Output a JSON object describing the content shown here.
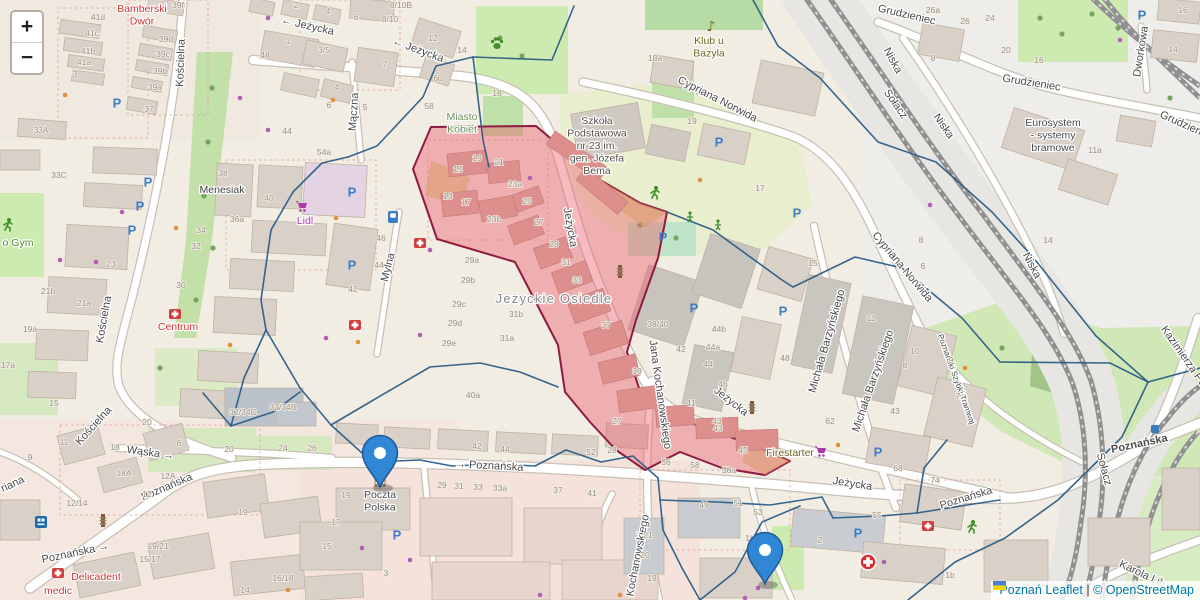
{
  "controls": {
    "zoom_in": "+",
    "zoom_out": "−"
  },
  "attribution": {
    "city": "Poznań",
    "leaflet": "Leaflet",
    "sep": " | ",
    "osm": "© OpenStreetMap"
  },
  "colors": {
    "overlay_blue": "#2c5d86",
    "highlight_fill": "#ec5a68",
    "highlight_border": "#8e1b40",
    "marker_blue": "#3187d6",
    "marker_border": "#205a96",
    "parking_blue": "#3d7dc8",
    "shop_purple": "#ac39ac",
    "amenity_red": "#cc3333",
    "leisure_green": "#3f8f29",
    "transit_blue": "#3a7abf"
  },
  "street_labels": [
    {
      "t": "Jeżycka",
      "x": 307,
      "y": 29,
      "r": 13,
      "a": "←",
      "ap": "pre"
    },
    {
      "t": "Jeżycka",
      "x": 417,
      "y": 53,
      "r": 20,
      "a": "←",
      "ap": "pre"
    },
    {
      "t": "Jeżycka",
      "x": 567,
      "y": 228,
      "r": 80
    },
    {
      "t": "Jeżycka",
      "x": 729,
      "y": 404,
      "r": 38
    },
    {
      "t": "Jeżycka",
      "x": 852,
      "y": 487,
      "r": 9
    },
    {
      "t": "Mączna",
      "x": 357,
      "y": 112,
      "r": -86
    },
    {
      "t": "Mylna",
      "x": 391,
      "y": 268,
      "r": -76
    },
    {
      "t": "Kościelna",
      "x": 184,
      "y": 63,
      "r": -88
    },
    {
      "t": "Kościelna",
      "x": 107,
      "y": 320,
      "r": -80
    },
    {
      "t": "Kościelna",
      "x": 96,
      "y": 428,
      "r": -48
    },
    {
      "t": "Wąska",
      "x": 150,
      "y": 456,
      "r": 8,
      "a": "→",
      "ap": "suf"
    },
    {
      "t": "Poznańska",
      "x": 168,
      "y": 490,
      "r": -23
    },
    {
      "t": "Poznańska",
      "x": 76,
      "y": 556,
      "r": -12,
      "a": "→",
      "ap": "suf"
    },
    {
      "t": "Poznańska",
      "x": 489,
      "y": 469,
      "r": 3,
      "a": "→",
      "ap": "pre"
    },
    {
      "t": "Poznańska",
      "x": 967,
      "y": 501,
      "r": -17
    },
    {
      "t": "Cypriana Norwida",
      "x": 716,
      "y": 102,
      "r": 27
    },
    {
      "t": "Cypriana Norwida",
      "x": 900,
      "y": 269,
      "r": 50
    },
    {
      "t": "Niska",
      "x": 890,
      "y": 62,
      "r": 62
    },
    {
      "t": "Niska",
      "x": 941,
      "y": 128,
      "r": 55
    },
    {
      "t": "Niska",
      "x": 1029,
      "y": 267,
      "r": 62
    },
    {
      "t": "Grudzieniec",
      "x": 906,
      "y": 18,
      "r": 13
    },
    {
      "t": "Grudzieniec",
      "x": 1031,
      "y": 86,
      "r": 9
    },
    {
      "t": "Grudzieniec",
      "x": 1186,
      "y": 129,
      "r": 24
    },
    {
      "t": "Dworkowa",
      "x": 1144,
      "y": 52,
      "r": -81
    },
    {
      "t": "Michała Barzyńskiego",
      "x": 830,
      "y": 342,
      "r": -74
    },
    {
      "t": "Michała Barzyńskiego",
      "x": 876,
      "y": 382,
      "r": -71
    },
    {
      "t": "Jana Kochanowskiego",
      "x": 657,
      "y": 395,
      "r": 82
    },
    {
      "t": "Kochanowskiego",
      "x": 641,
      "y": 556,
      "r": -79
    },
    {
      "t": "Sołacz",
      "x": 893,
      "y": 106,
      "r": 55
    },
    {
      "t": "Sołacz",
      "x": 1101,
      "y": 470,
      "r": 75
    },
    {
      "t": "Karola Lib",
      "x": 1141,
      "y": 577,
      "r": 25
    },
    {
      "t": "Kazimierza Pu",
      "x": 1181,
      "y": 358,
      "r": 55
    },
    {
      "t": "Poznański Szybki Tramwaj",
      "x": 954,
      "y": 380,
      "r": 70,
      "s": 8
    },
    {
      "t": "riana",
      "x": 14,
      "y": 487,
      "r": -25
    }
  ],
  "poi_labels": [
    {
      "lines": [
        "Bamberski",
        "Dwór"
      ],
      "x": 142,
      "y": 12,
      "c": "#cc3333"
    },
    {
      "lines": [
        "Miasto",
        "Kobiet"
      ],
      "x": 462,
      "y": 120,
      "c": "#6d8f57"
    },
    {
      "lines": [
        "Klub u",
        "Bazyla"
      ],
      "x": 709,
      "y": 44,
      "c": "#6e6424"
    },
    {
      "lines": [
        "Szkoła",
        "Podstawowa",
        "nr 23 im.",
        "gen. Józefa",
        "Bema"
      ],
      "x": 597,
      "y": 124,
      "c": "#55504a"
    },
    {
      "lines": [
        "Menesiak"
      ],
      "x": 222,
      "y": 193,
      "c": "#444444"
    },
    {
      "lines": [
        "Lidl"
      ],
      "x": 305,
      "y": 224,
      "c": "#ac39ac"
    },
    {
      "lines": [
        "Centrum"
      ],
      "x": 178,
      "y": 330,
      "c": "#cc3333"
    },
    {
      "lines": [
        "Jeżyckie Osiedle"
      ],
      "x": 554,
      "y": 303,
      "c": "#8a8a8a",
      "s": 13,
      "sp": 1.2
    },
    {
      "lines": [
        "Poczta",
        "Polska"
      ],
      "x": 380,
      "y": 498,
      "c": "#4a4a4a"
    },
    {
      "lines": [
        "Delicadent"
      ],
      "x": 96,
      "y": 580,
      "c": "#cc3333"
    },
    {
      "lines": [
        "medic"
      ],
      "x": 58,
      "y": 594,
      "c": "#cc3333"
    },
    {
      "lines": [
        "Firestarter"
      ],
      "x": 790,
      "y": 456,
      "c": "#6e6424"
    },
    {
      "lines": [
        "Eurosystem",
        "- systemy",
        "bramowe"
      ],
      "x": 1053,
      "y": 126,
      "c": "#4a4a4a"
    },
    {
      "lines": [
        "o Gym"
      ],
      "x": 18,
      "y": 246,
      "c": "#3f8f29"
    }
  ],
  "transit_stop": {
    "t": "Poznańska",
    "x": 1140,
    "y": 447,
    "r": -12,
    "icon_x": 1155,
    "icon_y": 429
  },
  "house_numbers": [
    {
      "t": "41d",
      "x": 98,
      "y": 20
    },
    {
      "t": "41c",
      "x": 92,
      "y": 36
    },
    {
      "t": "41b",
      "x": 88,
      "y": 54
    },
    {
      "t": "41a",
      "x": 84,
      "y": 65
    },
    {
      "t": "39f",
      "x": 178,
      "y": 8
    },
    {
      "t": "39d",
      "x": 166,
      "y": 42
    },
    {
      "t": "39c",
      "x": 163,
      "y": 57
    },
    {
      "t": "39b",
      "x": 160,
      "y": 74
    },
    {
      "t": "39a",
      "x": 155,
      "y": 90
    },
    {
      "t": "37",
      "x": 149,
      "y": 112
    },
    {
      "t": "33A",
      "x": 41,
      "y": 133
    },
    {
      "t": "33C",
      "x": 59,
      "y": 178
    },
    {
      "t": "3",
      "x": 75,
      "y": 77
    },
    {
      "t": "2",
      "x": 296,
      "y": 8
    },
    {
      "t": "4",
      "x": 328,
      "y": 14
    },
    {
      "t": "6",
      "x": 356,
      "y": 20
    },
    {
      "t": "8/10B",
      "x": 401,
      "y": 8
    },
    {
      "t": "8/10",
      "x": 390,
      "y": 22
    },
    {
      "t": "12",
      "x": 433,
      "y": 41
    },
    {
      "t": "14",
      "x": 462,
      "y": 53
    },
    {
      "t": "1",
      "x": 288,
      "y": 44
    },
    {
      "t": "3/5",
      "x": 324,
      "y": 53
    },
    {
      "t": "48",
      "x": 265,
      "y": 58
    },
    {
      "t": "7",
      "x": 385,
      "y": 67
    },
    {
      "t": "4",
      "x": 337,
      "y": 90
    },
    {
      "t": "6",
      "x": 329,
      "y": 108
    },
    {
      "t": "5",
      "x": 365,
      "y": 110
    },
    {
      "t": "60",
      "x": 438,
      "y": 81
    },
    {
      "t": "58",
      "x": 429,
      "y": 109
    },
    {
      "t": "44",
      "x": 287,
      "y": 134
    },
    {
      "t": "54a",
      "x": 324,
      "y": 155
    },
    {
      "t": "18",
      "x": 497,
      "y": 96
    },
    {
      "t": "18a",
      "x": 655,
      "y": 61
    },
    {
      "t": "19",
      "x": 692,
      "y": 124
    },
    {
      "t": "26a",
      "x": 933,
      "y": 13
    },
    {
      "t": "26",
      "x": 965,
      "y": 24
    },
    {
      "t": "24",
      "x": 990,
      "y": 21
    },
    {
      "t": "20",
      "x": 1006,
      "y": 53
    },
    {
      "t": "16",
      "x": 1039,
      "y": 63
    },
    {
      "t": "8",
      "x": 933,
      "y": 61
    },
    {
      "t": "16",
      "x": 1183,
      "y": 13
    },
    {
      "t": "14",
      "x": 1173,
      "y": 52
    },
    {
      "t": "11a",
      "x": 1095,
      "y": 153
    },
    {
      "t": "19",
      "x": 477,
      "y": 161
    },
    {
      "t": "21",
      "x": 499,
      "y": 165
    },
    {
      "t": "15",
      "x": 458,
      "y": 172
    },
    {
      "t": "13",
      "x": 448,
      "y": 199
    },
    {
      "t": "17",
      "x": 466,
      "y": 205
    },
    {
      "t": "23a",
      "x": 515,
      "y": 187
    },
    {
      "t": "25",
      "x": 527,
      "y": 204
    },
    {
      "t": "23b",
      "x": 494,
      "y": 222
    },
    {
      "t": "27",
      "x": 539,
      "y": 225
    },
    {
      "t": "29",
      "x": 554,
      "y": 247
    },
    {
      "t": "31",
      "x": 566,
      "y": 265
    },
    {
      "t": "29a",
      "x": 472,
      "y": 263
    },
    {
      "t": "29b",
      "x": 468,
      "y": 283
    },
    {
      "t": "29c",
      "x": 459,
      "y": 307
    },
    {
      "t": "29d",
      "x": 455,
      "y": 326
    },
    {
      "t": "29e",
      "x": 449,
      "y": 346
    },
    {
      "t": "31b",
      "x": 516,
      "y": 317
    },
    {
      "t": "31a",
      "x": 507,
      "y": 341
    },
    {
      "t": "40a",
      "x": 473,
      "y": 398
    },
    {
      "t": "33",
      "x": 577,
      "y": 283
    },
    {
      "t": "37",
      "x": 606,
      "y": 328
    },
    {
      "t": "39",
      "x": 637,
      "y": 374
    },
    {
      "t": "38/40",
      "x": 658,
      "y": 327
    },
    {
      "t": "42",
      "x": 681,
      "y": 352
    },
    {
      "t": "44b",
      "x": 719,
      "y": 332
    },
    {
      "t": "44a",
      "x": 713,
      "y": 350
    },
    {
      "t": "44",
      "x": 708,
      "y": 367
    },
    {
      "t": "46",
      "x": 723,
      "y": 387
    },
    {
      "t": "41",
      "x": 691,
      "y": 406
    },
    {
      "t": "43",
      "x": 717,
      "y": 424
    },
    {
      "t": "38",
      "x": 223,
      "y": 176
    },
    {
      "t": "40",
      "x": 269,
      "y": 201
    },
    {
      "t": "36a",
      "x": 237,
      "y": 222
    },
    {
      "t": "34",
      "x": 201,
      "y": 233
    },
    {
      "t": "32",
      "x": 196,
      "y": 249
    },
    {
      "t": "30",
      "x": 181,
      "y": 288
    },
    {
      "t": "23",
      "x": 111,
      "y": 267
    },
    {
      "t": "21b",
      "x": 48,
      "y": 294
    },
    {
      "t": "21a",
      "x": 84,
      "y": 306
    },
    {
      "t": "19a",
      "x": 30,
      "y": 332
    },
    {
      "t": "17a",
      "x": 8,
      "y": 368
    },
    {
      "t": "46",
      "x": 381,
      "y": 241
    },
    {
      "t": "44",
      "x": 379,
      "y": 268
    },
    {
      "t": "42",
      "x": 353,
      "y": 292
    },
    {
      "t": "15",
      "x": 54,
      "y": 406
    },
    {
      "t": "11",
      "x": 64,
      "y": 445
    },
    {
      "t": "9",
      "x": 30,
      "y": 460
    },
    {
      "t": "18",
      "x": 115,
      "y": 450
    },
    {
      "t": "18A",
      "x": 124,
      "y": 476
    },
    {
      "t": "12A",
      "x": 168,
      "y": 479
    },
    {
      "t": "12",
      "x": 147,
      "y": 497
    },
    {
      "t": "12/14",
      "x": 77,
      "y": 506
    },
    {
      "t": "20",
      "x": 147,
      "y": 425
    },
    {
      "t": "6",
      "x": 179,
      "y": 446
    },
    {
      "t": "20",
      "x": 229,
      "y": 452
    },
    {
      "t": "24",
      "x": 283,
      "y": 451
    },
    {
      "t": "26",
      "x": 312,
      "y": 451
    },
    {
      "t": "19",
      "x": 243,
      "y": 515
    },
    {
      "t": "19/21",
      "x": 158,
      "y": 549
    },
    {
      "t": "15/17",
      "x": 150,
      "y": 562
    },
    {
      "t": "16/18",
      "x": 283,
      "y": 581
    },
    {
      "t": "14",
      "x": 245,
      "y": 593
    },
    {
      "t": "32/34C",
      "x": 243,
      "y": 415
    },
    {
      "t": "32/34B",
      "x": 283,
      "y": 410
    },
    {
      "t": "42",
      "x": 477,
      "y": 449
    },
    {
      "t": "44",
      "x": 505,
      "y": 452
    },
    {
      "t": "52",
      "x": 591,
      "y": 455
    },
    {
      "t": "28",
      "x": 612,
      "y": 453
    },
    {
      "t": "29",
      "x": 442,
      "y": 488
    },
    {
      "t": "31",
      "x": 459,
      "y": 489
    },
    {
      "t": "33",
      "x": 478,
      "y": 490
    },
    {
      "t": "33a",
      "x": 500,
      "y": 491
    },
    {
      "t": "37",
      "x": 558,
      "y": 493
    },
    {
      "t": "41",
      "x": 592,
      "y": 496
    },
    {
      "t": "19",
      "x": 346,
      "y": 498
    },
    {
      "t": "17",
      "x": 336,
      "y": 525
    },
    {
      "t": "15",
      "x": 327,
      "y": 549
    },
    {
      "t": "3",
      "x": 386,
      "y": 576
    },
    {
      "t": "27",
      "x": 617,
      "y": 424
    },
    {
      "t": "43",
      "x": 718,
      "y": 431
    },
    {
      "t": "45",
      "x": 743,
      "y": 453
    },
    {
      "t": "56",
      "x": 666,
      "y": 465
    },
    {
      "t": "58",
      "x": 695,
      "y": 468
    },
    {
      "t": "58a",
      "x": 729,
      "y": 473
    },
    {
      "t": "62",
      "x": 830,
      "y": 424
    },
    {
      "t": "49",
      "x": 704,
      "y": 508
    },
    {
      "t": "51",
      "x": 738,
      "y": 506
    },
    {
      "t": "53",
      "x": 758,
      "y": 515
    },
    {
      "t": "55",
      "x": 877,
      "y": 518
    },
    {
      "t": "68",
      "x": 898,
      "y": 471
    },
    {
      "t": "74",
      "x": 935,
      "y": 483
    },
    {
      "t": "21",
      "x": 648,
      "y": 538
    },
    {
      "t": "20",
      "x": 645,
      "y": 558
    },
    {
      "t": "19",
      "x": 652,
      "y": 581
    },
    {
      "t": "1b",
      "x": 750,
      "y": 541
    },
    {
      "t": "2",
      "x": 820,
      "y": 543
    },
    {
      "t": "1b",
      "x": 950,
      "y": 578
    },
    {
      "t": "15",
      "x": 813,
      "y": 266
    },
    {
      "t": "8",
      "x": 921,
      "y": 243
    },
    {
      "t": "6",
      "x": 923,
      "y": 269
    },
    {
      "t": "11",
      "x": 871,
      "y": 321
    },
    {
      "t": "10",
      "x": 915,
      "y": 354
    },
    {
      "t": "8",
      "x": 905,
      "y": 368
    },
    {
      "t": "9",
      "x": 951,
      "y": 363
    },
    {
      "t": "7",
      "x": 958,
      "y": 399
    },
    {
      "t": "43",
      "x": 895,
      "y": 414
    },
    {
      "t": "48",
      "x": 785,
      "y": 361
    },
    {
      "t": "14",
      "x": 1048,
      "y": 243
    },
    {
      "t": "17",
      "x": 760,
      "y": 191
    }
  ],
  "parking": [
    [
      117,
      103
    ],
    [
      148,
      182
    ],
    [
      140,
      206
    ],
    [
      132,
      230
    ],
    [
      352,
      192
    ],
    [
      352,
      265
    ],
    [
      663,
      237
    ],
    [
      719,
      142
    ],
    [
      797,
      213
    ],
    [
      783,
      311
    ],
    [
      694,
      308
    ],
    [
      878,
      452
    ],
    [
      858,
      533
    ],
    [
      397,
      535
    ],
    [
      1142,
      15
    ]
  ],
  "icons": [
    {
      "type": "paw",
      "x": 497,
      "y": 43
    },
    {
      "type": "music-note",
      "x": 711,
      "y": 27
    },
    {
      "type": "runner",
      "x": 655,
      "y": 193
    },
    {
      "type": "runner",
      "x": 972,
      "y": 527
    },
    {
      "type": "runner",
      "x": 8,
      "y": 225
    },
    {
      "type": "playground",
      "x": 690,
      "y": 217
    },
    {
      "type": "playground",
      "x": 718,
      "y": 225
    },
    {
      "type": "monument",
      "x": 103,
      "y": 521
    },
    {
      "type": "monument",
      "x": 620,
      "y": 272
    },
    {
      "type": "monument",
      "x": 752,
      "y": 408
    },
    {
      "type": "bus",
      "x": 41,
      "y": 522
    },
    {
      "type": "envelope",
      "x": 380,
      "y": 483
    },
    {
      "type": "cart",
      "x": 303,
      "y": 207
    },
    {
      "type": "cart",
      "x": 822,
      "y": 452
    },
    {
      "type": "first-aid",
      "x": 420,
      "y": 243
    },
    {
      "type": "first-aid",
      "x": 355,
      "y": 325
    },
    {
      "type": "first-aid",
      "x": 175,
      "y": 314
    },
    {
      "type": "first-aid",
      "x": 58,
      "y": 573
    },
    {
      "type": "first-aid",
      "x": 928,
      "y": 526
    },
    {
      "type": "emergency-cross",
      "x": 868,
      "y": 562
    },
    {
      "type": "fuel",
      "x": 393,
      "y": 217
    }
  ],
  "markers": [
    {
      "x": 380,
      "y": 487,
      "name": "marker-poczta-polska"
    },
    {
      "x": 765,
      "y": 584,
      "name": "marker-south"
    }
  ]
}
